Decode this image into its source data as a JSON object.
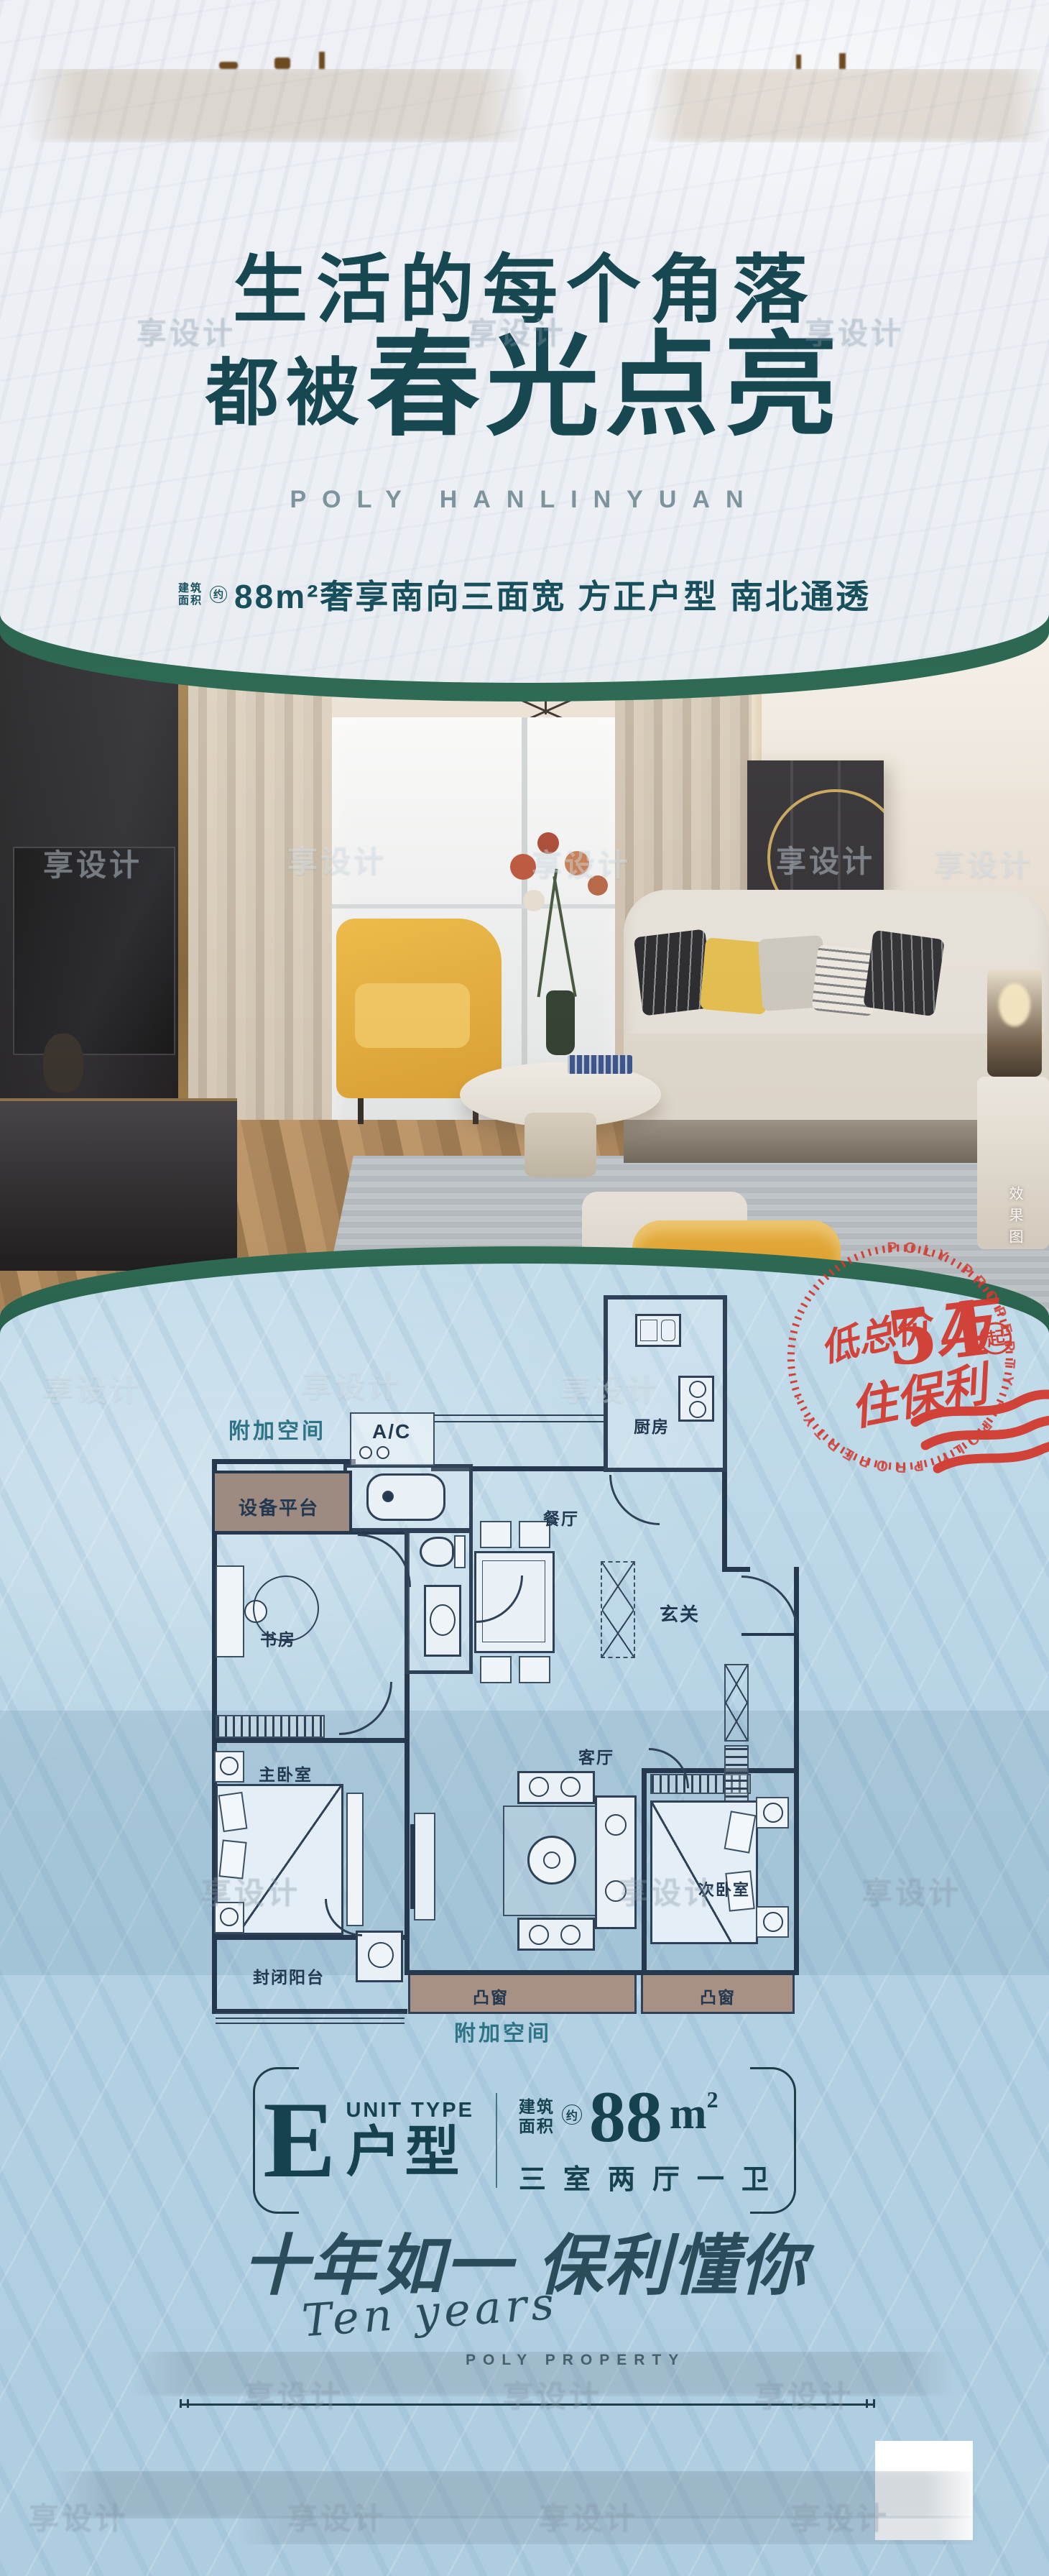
{
  "watermark": {
    "text": "享设计"
  },
  "hero": {
    "headline_line1": "生活的每个角落",
    "headline_line2_prefix": "都被",
    "headline_line2_main": "春光点亮",
    "brand_en": "POLY HANLINYUAN",
    "tagline_prefix_top": "建筑",
    "tagline_prefix_bottom": "面积",
    "tagline_circle": "约",
    "tagline_main": "88m²奢享南向三面宽 方正户型 南北通透"
  },
  "photo": {
    "corner_tag": "效果图"
  },
  "stamp": {
    "ring_text": "POLY PROPERTY · POLY PROPERTY ·",
    "line1_prefix": "低总价",
    "line1_value": "54",
    "line1_unit": "万",
    "circle_char": "起",
    "line2": "住保利"
  },
  "floorplan": {
    "labels": [
      {
        "t": "附加空间"
      },
      {
        "t": "A/C"
      },
      {
        "t": "设备平台"
      },
      {
        "t": "厨房"
      },
      {
        "t": "餐厅"
      },
      {
        "t": "玄关"
      },
      {
        "t": "书房"
      },
      {
        "t": "主卧室"
      },
      {
        "t": "客厅"
      },
      {
        "t": "次卧室"
      },
      {
        "t": "封闭阳台"
      },
      {
        "t": "凸窗"
      },
      {
        "t": "凸窗"
      },
      {
        "t": "附加空间"
      }
    ]
  },
  "unit": {
    "letter": "E",
    "type_en": "UNIT TYPE",
    "type_cn": "户型",
    "area_prefix_top": "建筑",
    "area_prefix_bottom": "面积",
    "area_circle": "约",
    "area_value": "88",
    "area_unit": "m",
    "area_sup": "2",
    "rooms": "三室两厅一卫"
  },
  "slogan": {
    "cn": "十年如一 保利懂你",
    "en_script": "Ten years",
    "en_caps": "POLY PROPERTY"
  },
  "colors": {
    "teal": "#17505c",
    "green_rim": "#265c4b",
    "stamp_red": "#d23b30",
    "plan_wall": "#26384e"
  }
}
